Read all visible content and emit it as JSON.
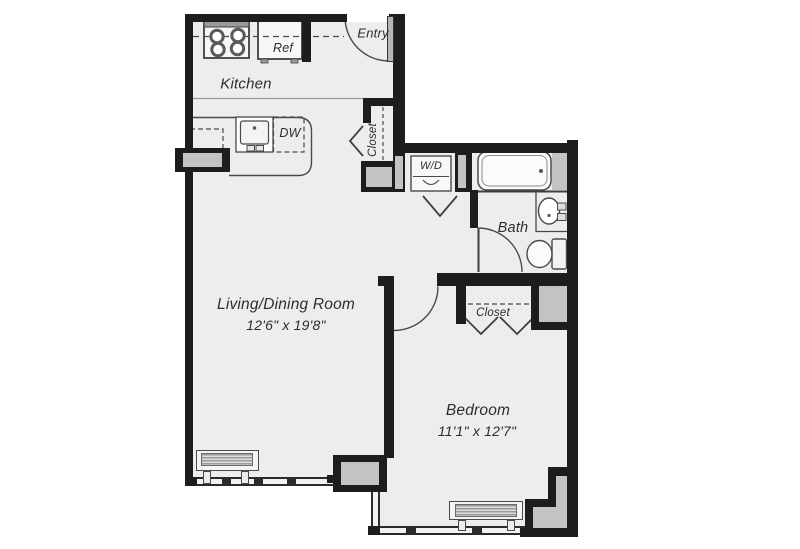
{
  "colors": {
    "wall": "#1d1d1d",
    "floor": "#ededed",
    "column_block": "#c3c3c3",
    "linework": "#4a4a4a"
  },
  "rooms": {
    "kitchen": {
      "label": "Kitchen"
    },
    "entry": {
      "label": "Entry"
    },
    "entry_closet": {
      "label": "Closet"
    },
    "living_dining": {
      "label": "Living/Dining Room",
      "dimensions": "12'6\" x 19'8\""
    },
    "bath": {
      "label": "Bath"
    },
    "bedroom": {
      "label": "Bedroom",
      "dimensions": "11'1\" x 12'7\""
    },
    "bedroom_closet": {
      "label": "Closet"
    }
  },
  "appliances": {
    "refrigerator": {
      "label": "Ref"
    },
    "dishwasher": {
      "label": "DW"
    },
    "washer_dryer": {
      "label": "W/D"
    }
  }
}
